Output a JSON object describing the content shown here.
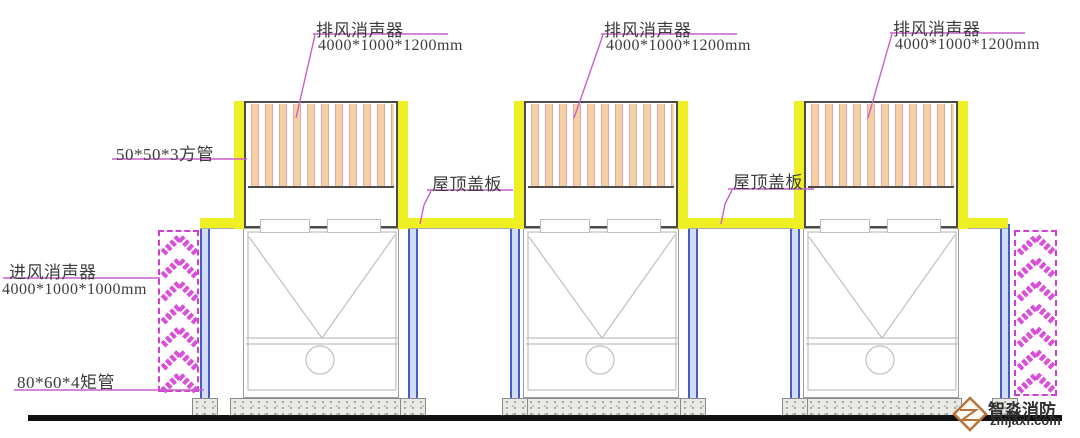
{
  "drawing": {
    "type": "cooling-tower-silencer-elevation",
    "units_count": 3,
    "labels": {
      "exhaust_silencer": {
        "title": "排风消声器",
        "dims": "4000*1000*1200mm"
      },
      "square_tube": "50*50*3方管",
      "roof_cover": "屋顶盖板",
      "intake_silencer": {
        "title": "进风消声器",
        "dims": "4000*1000*1000mm"
      },
      "rect_tube": "80*60*4矩管"
    }
  },
  "watermark": {
    "brand": "智淼消防",
    "site": "zmjaxf.com"
  },
  "colors": {
    "roof_plate_yellow": "#eff024",
    "silencer_magenta": "#cf3ecf",
    "column_blue_edge": "#4a5cc8",
    "column_blue_fill": "#d2ddf5",
    "slat_peach": "#f3d1a2",
    "concrete_gray": "#e9e9e6",
    "ground_black": "#111111",
    "leader_pink": "#c85fc8",
    "logo_orange": "#b5733d"
  }
}
